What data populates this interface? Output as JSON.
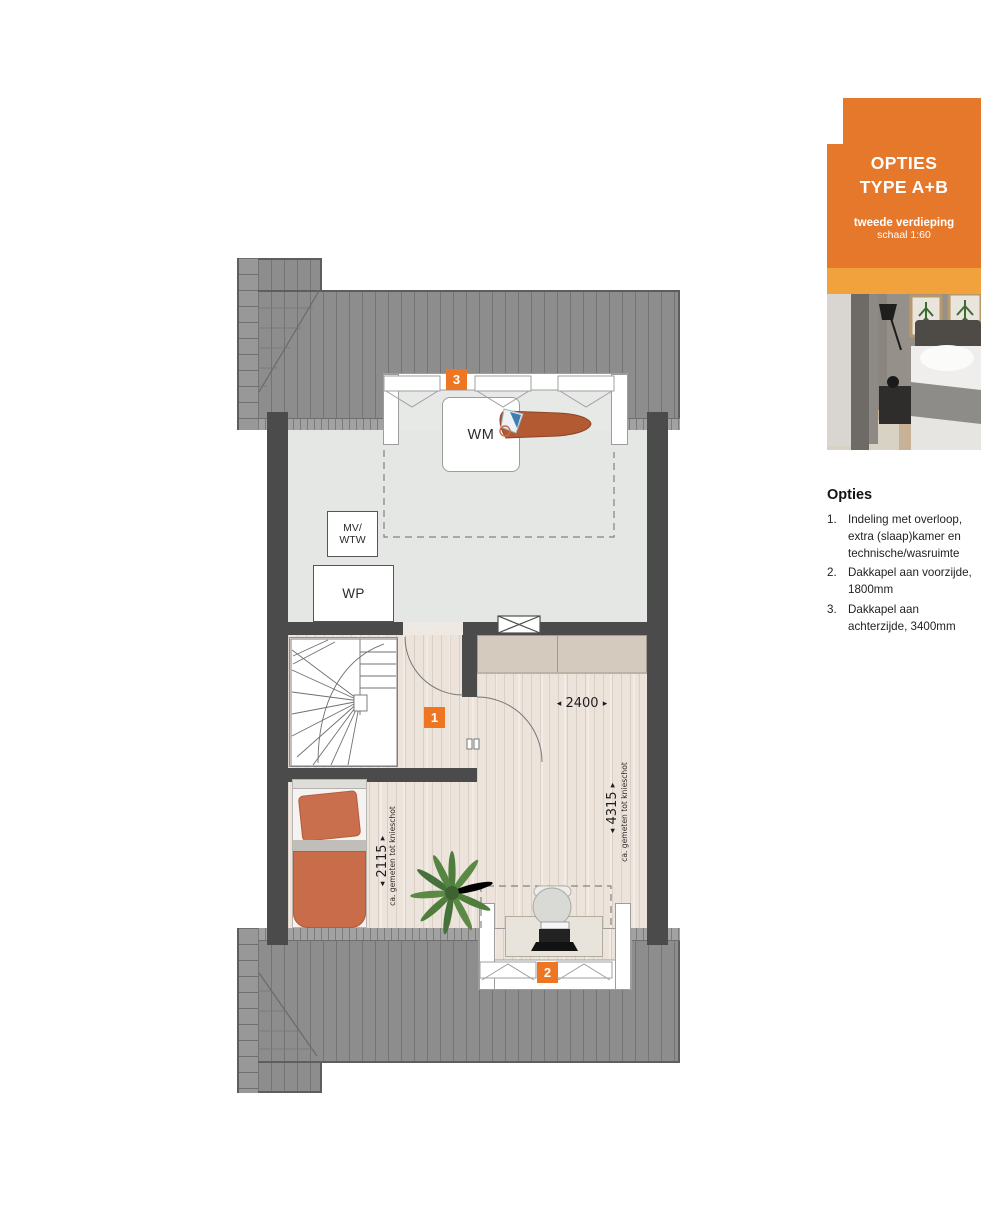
{
  "sidebar": {
    "panel": {
      "title_line1": "OPTIES",
      "title_line2": "TYPE A+B",
      "subtitle": "tweede verdieping",
      "scale": "schaal 1:60"
    },
    "photo": "bedroom-photo",
    "options": {
      "heading": "Opties",
      "items": [
        {
          "num": "1.",
          "text": "Indeling met overloop, extra (slaap)kamer en technische/wasruimte"
        },
        {
          "num": "2.",
          "text": "Dakkapel aan voorzijde, 1800mm"
        },
        {
          "num": "3.",
          "text": "Dakkapel aan achterzijde, 3400mm"
        }
      ]
    }
  },
  "plan": {
    "labels": {
      "wm": "WM",
      "mv_wtw": "MV/\nWTW",
      "wp": "WP"
    },
    "markers": {
      "m1": "1",
      "m2": "2",
      "m3": "3"
    },
    "dimensions": {
      "room_width": {
        "value": "2400"
      },
      "depth_right": {
        "value": "4315",
        "note": "ca. gemeten tot knieschot"
      },
      "depth_left": {
        "value": "2115",
        "note": "ca. gemeten tot knieschot"
      }
    },
    "icons": {
      "arrow_left": "◂",
      "arrow_right": "▸"
    }
  },
  "colors": {
    "accent_orange": "#e6782c",
    "accent_orange_light": "#f2a23d",
    "marker_orange": "#ee7623",
    "wall_dark": "#4b4b4b",
    "roof_gray": "#8d8d8d",
    "tech_floor": "#e5e7e4",
    "wood_floor": "#ece3db",
    "wardrobe_beige": "#d4cabd",
    "terracotta": "#c96c49",
    "plant_green": "#4f7d3c"
  }
}
